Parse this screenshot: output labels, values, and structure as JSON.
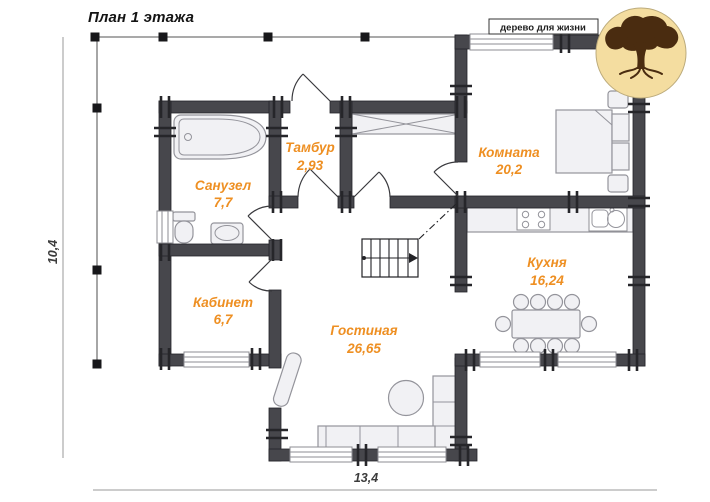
{
  "title": "План 1 этажа",
  "logo": {
    "tagline": "дерево для жизни",
    "circle_color": "#f4dda0",
    "tree_color": "#4a2c10"
  },
  "rooms": [
    {
      "name": "Санузел",
      "area": "7,7"
    },
    {
      "name": "Тамбур",
      "area": "2,93"
    },
    {
      "name": "Комната",
      "area": "20,2"
    },
    {
      "name": "Кабинет",
      "area": "6,7"
    },
    {
      "name": "Гостиная",
      "area": "26,65"
    },
    {
      "name": "Кухня",
      "area": "16,24"
    }
  ],
  "dimensions": {
    "width_label": "13,4",
    "height_label": "10,4"
  },
  "colors": {
    "wall": "#47474c",
    "room_label": "#ee8f22",
    "furniture_fill": "#f1f1f4"
  }
}
